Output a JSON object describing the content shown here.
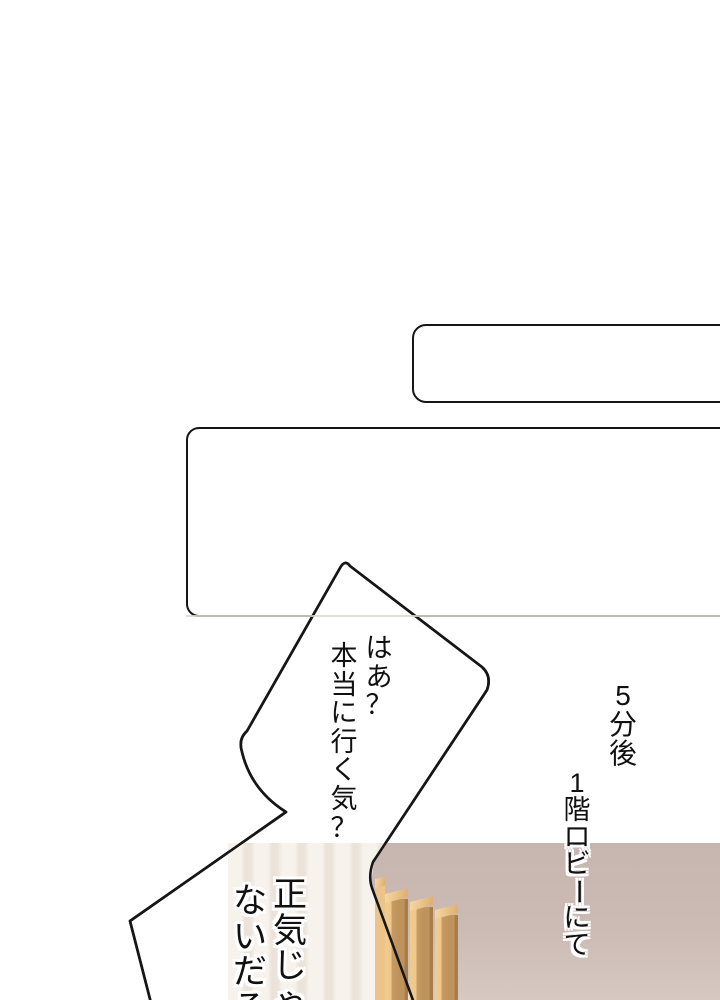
{
  "page": {
    "kind": "webtoon-manga-page",
    "background": "#ffffff"
  },
  "narration_boxes": {
    "box1_text": "",
    "box2_text": ""
  },
  "speech_bubble": {
    "line1": "はあ？",
    "line2": "本当に行く気？",
    "fill": "#ffffff",
    "outline": "#161616"
  },
  "captions": {
    "time": "5分後",
    "place": "1階ロビーにて"
  },
  "overlay_text": {
    "line1": "正気じゃ",
    "line2": "ないだろ"
  },
  "scene_panel": {
    "description_colors": {
      "mauve_wall": "#c9b7b2",
      "bright_wall": "#f6f1ea",
      "wall_stripe": "#ebe3d9",
      "wood_slat": "#c79c63",
      "wood_highlight": "#f1ca8e",
      "line": "#141414"
    }
  }
}
